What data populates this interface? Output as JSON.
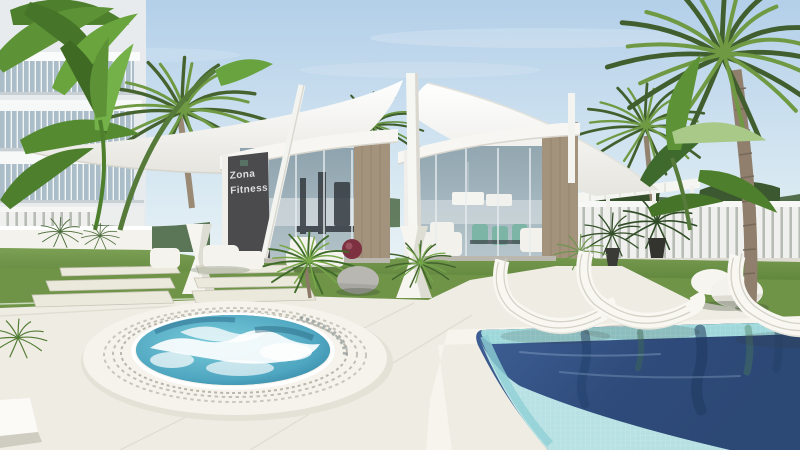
{
  "scene": {
    "type": "architectural-render",
    "description": "Resort amenity area: fitness pavilion and lounge pavilion under white tensile sail canopies, white slatted fences and pergola, palm and banana trees, lawn with stepping stones, round bubbling jacuzzi in white deck, mosaic-tiled swimming pool with white wire loungers and egg-shaped stones",
    "sign": {
      "line1": "Zona",
      "line2": "Fitness"
    },
    "elements": [
      "apartment-building",
      "sail-canopies",
      "fitness-pavilion",
      "lounge-pavilion",
      "pergola",
      "slatted-fence",
      "palm-trees",
      "banana-plants",
      "lawn",
      "stepping-stones",
      "jacuzzi",
      "swimming-pool",
      "sun-loungers",
      "egg-stones",
      "cycad-plants"
    ],
    "palette": {
      "sky_top": "#b3cfe9",
      "sky_horizon": "#eef5f8",
      "canopy_white": "#f7f6f2",
      "deck": "#efece3",
      "grass": "#6f9448",
      "foliage_dark": "#3f5c2d",
      "foliage_light": "#7ab04c",
      "wood_panel": "#a3937d",
      "sign_panel": "#4b4b4d",
      "sign_text": "#dfdfe2",
      "glass": "#97a9b4",
      "jacuzzi_water": "#4fa6c0",
      "pool_deep": "#33507e",
      "pool_mosaic": "#9ed8da",
      "pool_shallow": "#bfe9e9",
      "accent_cushion": "#7c3040",
      "teal_chairs": "#7cb5a5",
      "trunk": "#8f7f6c"
    }
  }
}
